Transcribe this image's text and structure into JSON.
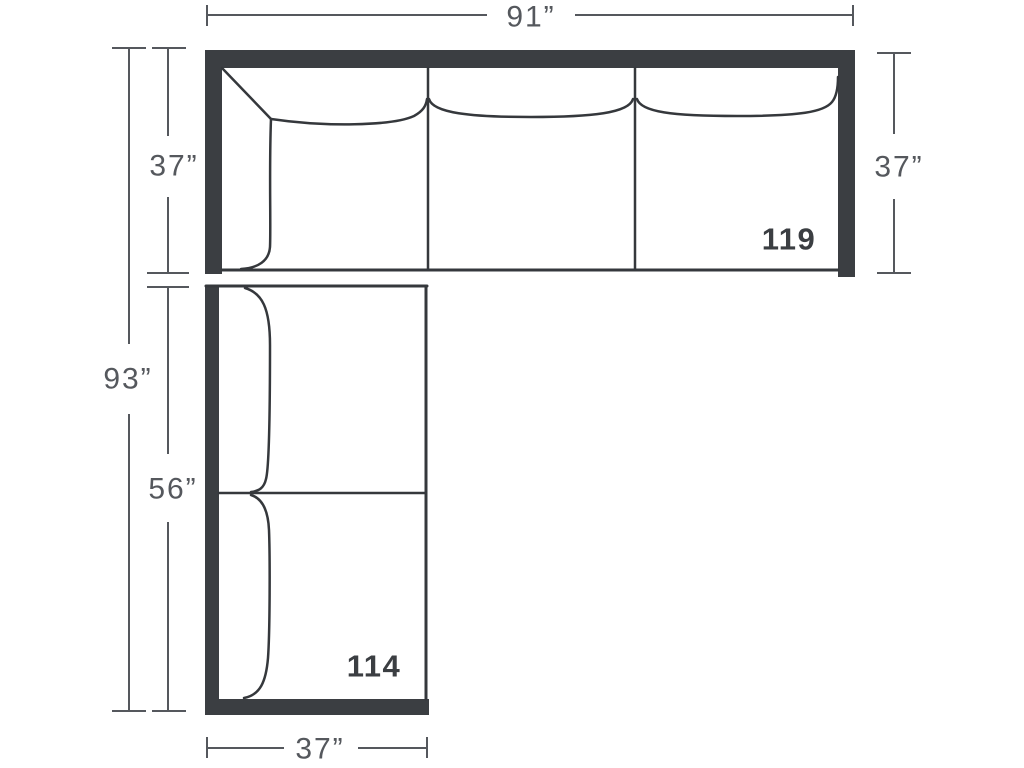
{
  "diagram": {
    "description": "Sectional sofa floor-plan dimension diagram, L-shaped: three-seat sofa on top (piece 119) and two-cushion chaise return on left-bottom (piece 114)",
    "colors": {
      "frame": "#3b3e42",
      "sofa_outline": "#35383c",
      "dimension": "#55585d",
      "piece_label": "#3b3e42",
      "background": "#ffffff"
    },
    "dims": {
      "top_width": "91”",
      "left_total_height": "93”",
      "left_upper_height": "37”",
      "left_lower_height": "56”",
      "right_height": "37”",
      "bottom_width": "37”"
    },
    "labels": {
      "top_piece": "119",
      "bottom_piece": "114"
    }
  }
}
